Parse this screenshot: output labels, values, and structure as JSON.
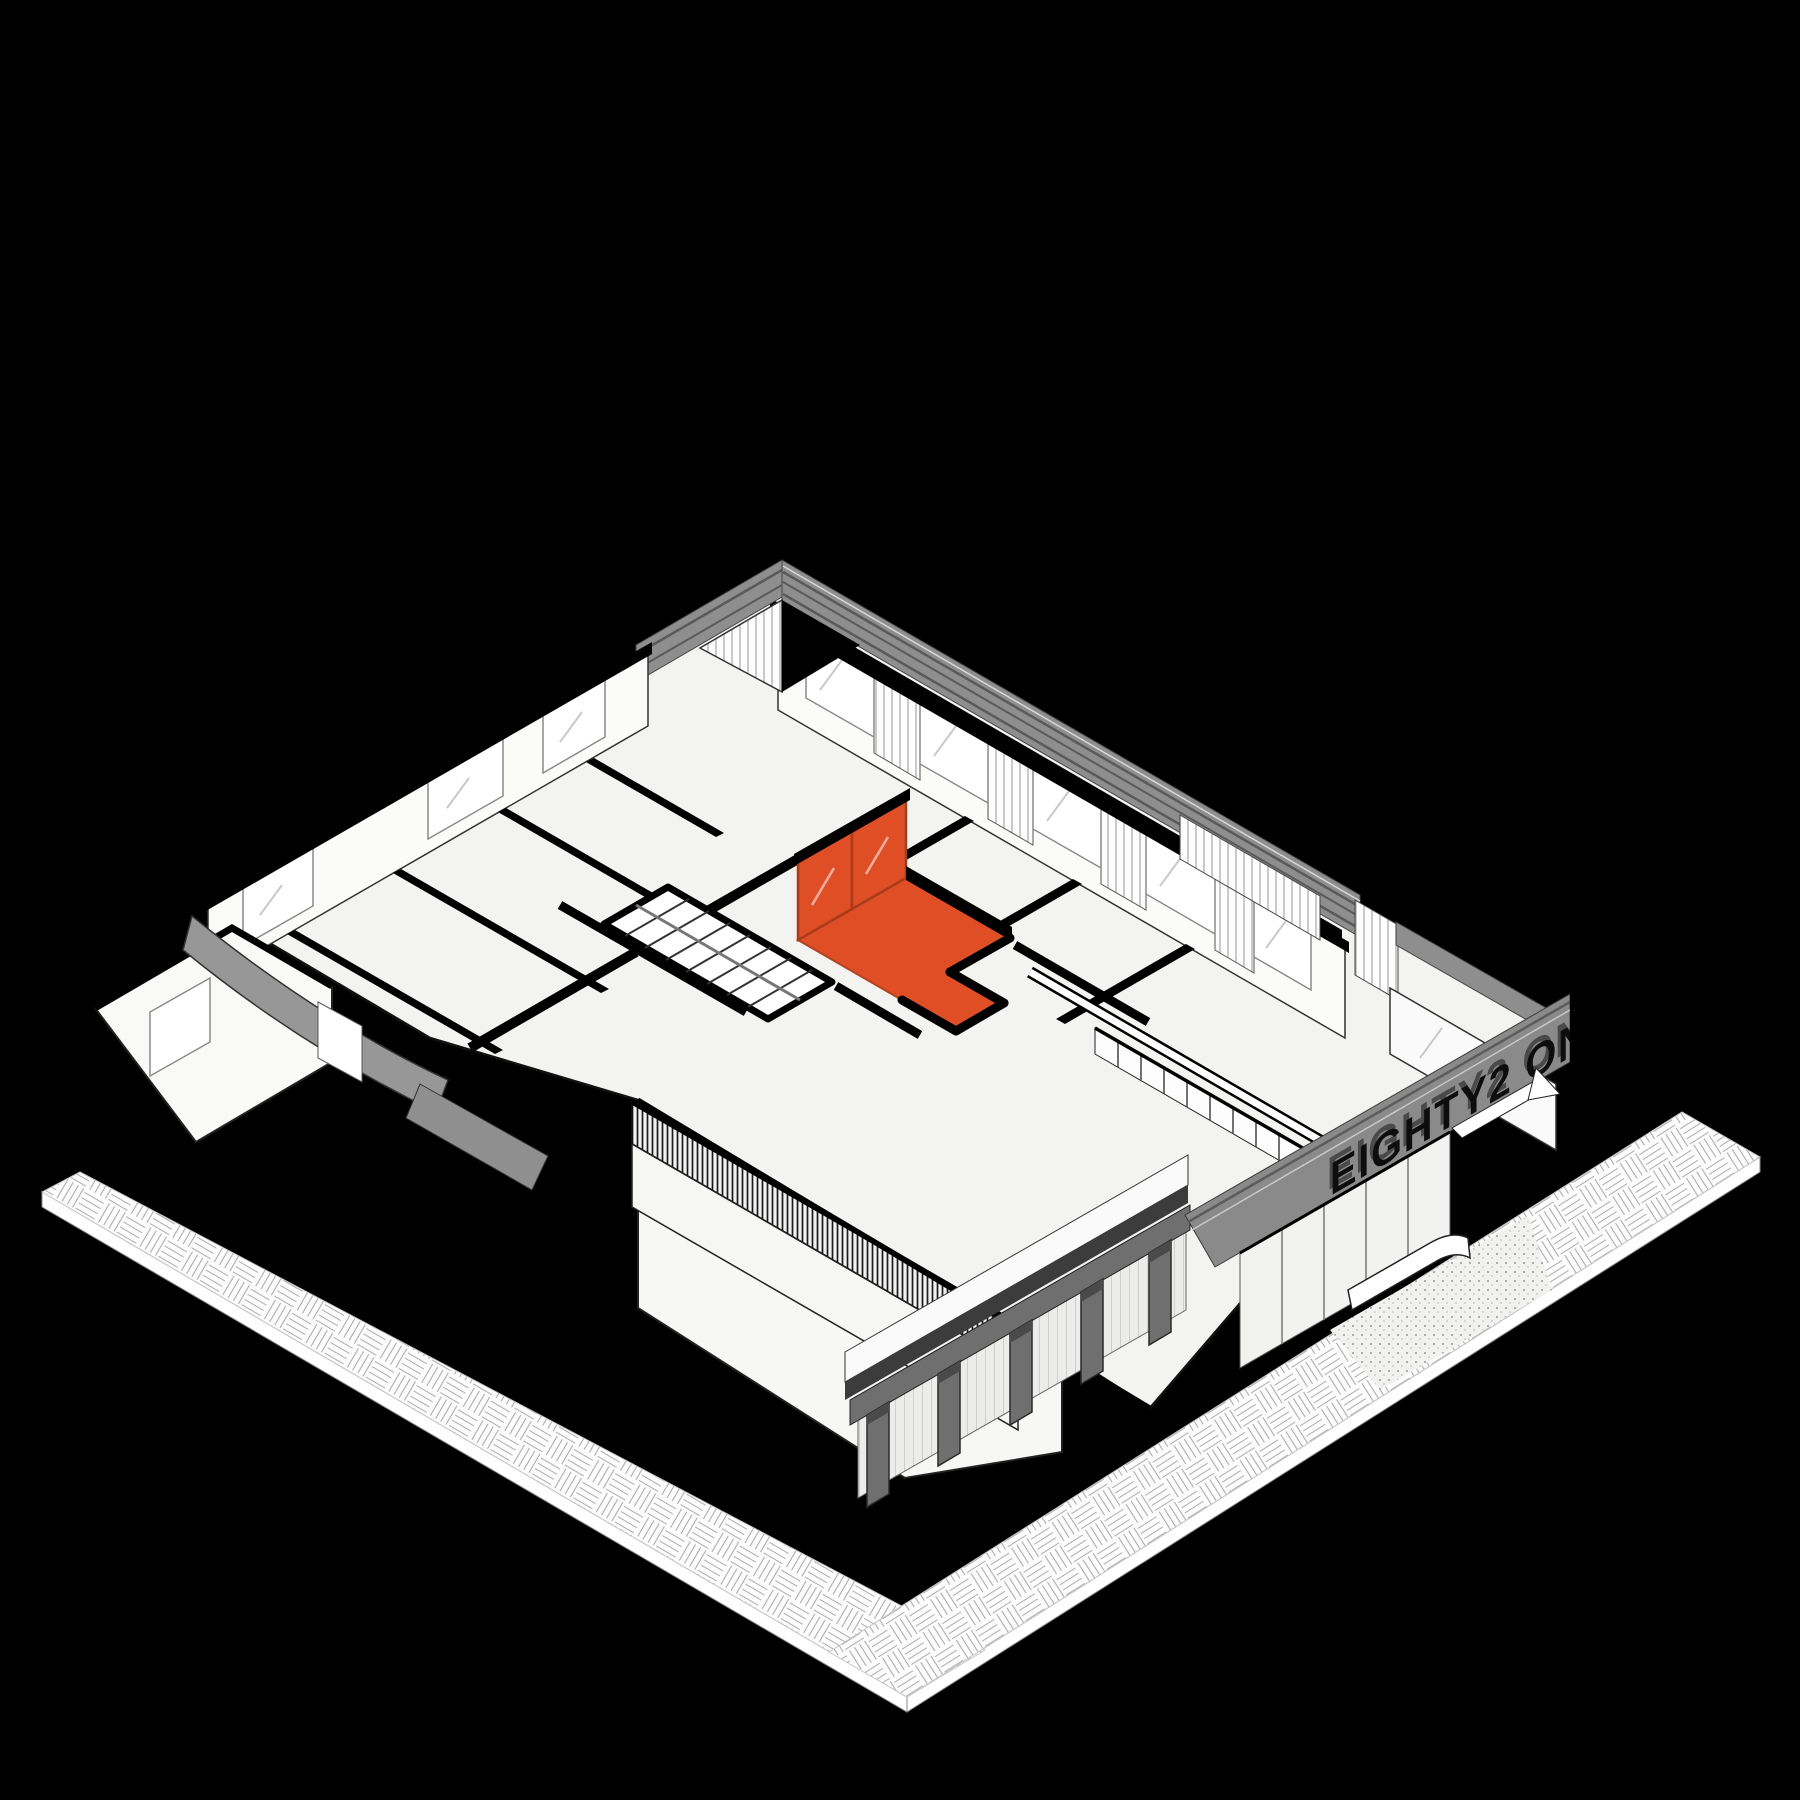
{
  "scene": {
    "sign": {
      "text": "EIGHTY2 ON M"
    },
    "colors": {
      "background": "#000000",
      "paper": "#ffffff",
      "floor": "#f3f3f1",
      "poche": "#000000",
      "parapet_gray": "#8e8e8e",
      "fascia_gray": "#8a8a8a",
      "column_gray": "#6f6f6f",
      "dark_beam": "#3c3c3c",
      "curved_wall_gray": "#979797",
      "highlight": "#e04e26",
      "highlight_dark": "#b4431d",
      "line": "#111111"
    }
  }
}
